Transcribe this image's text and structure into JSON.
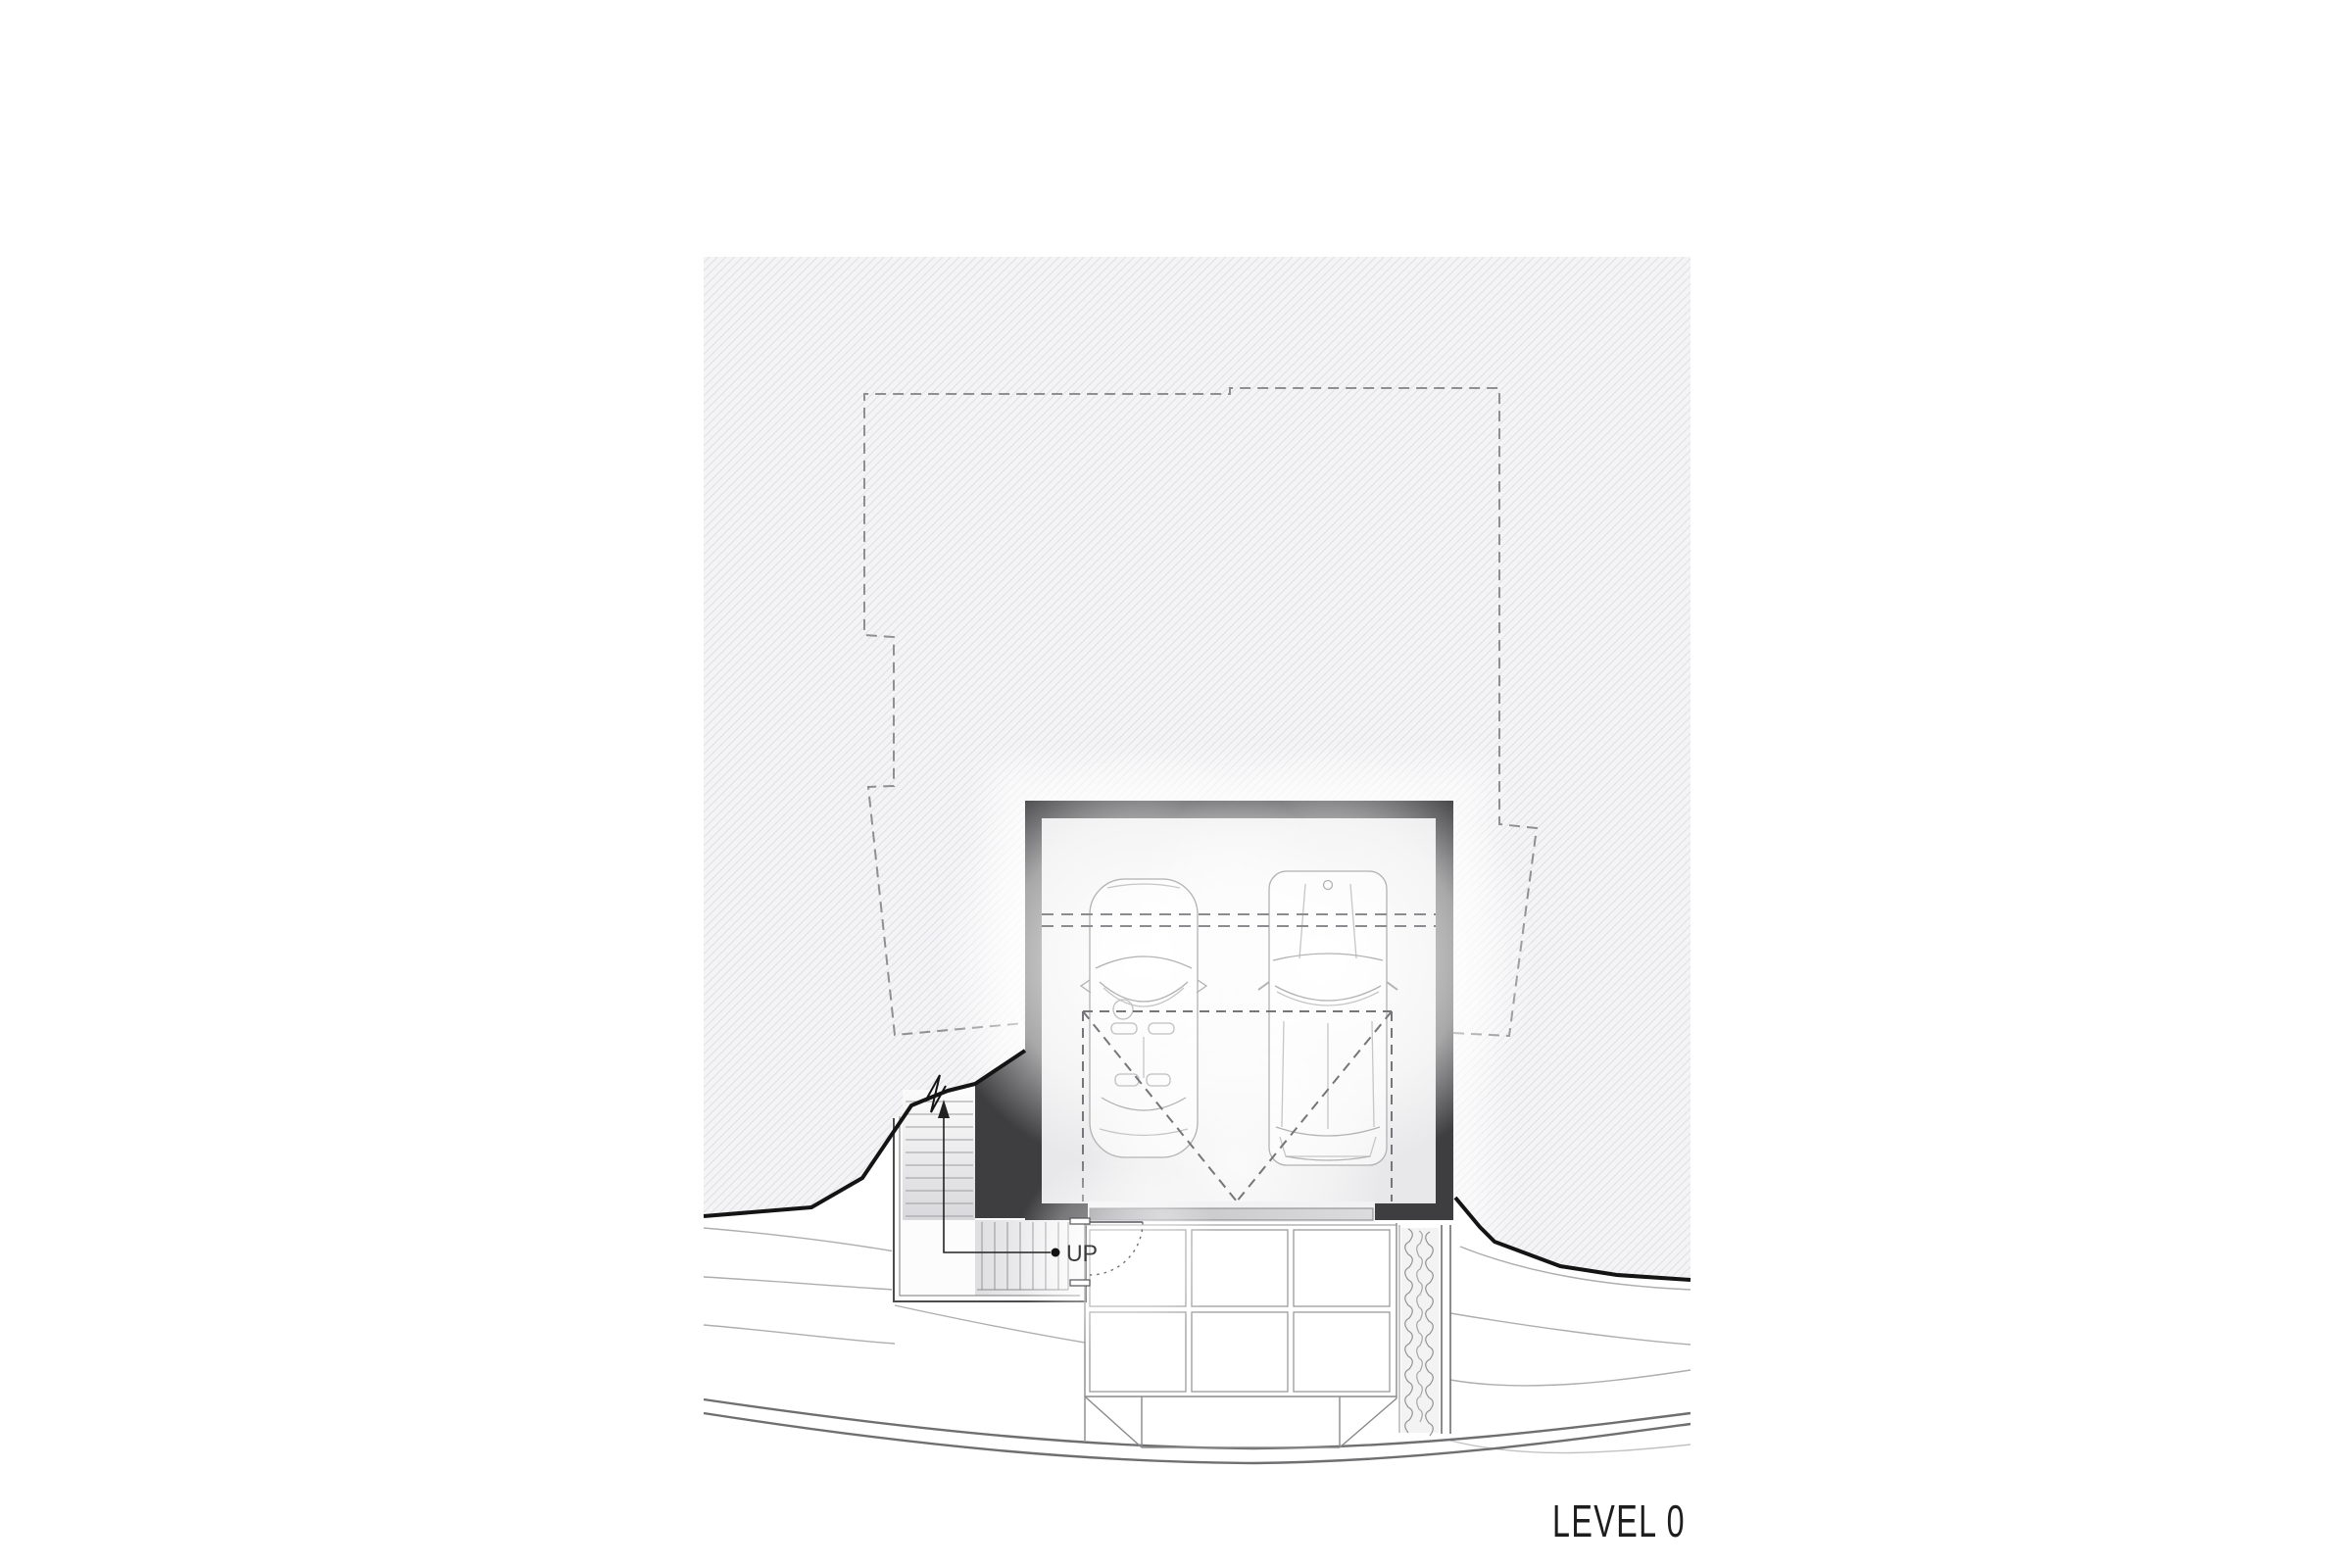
{
  "drawing": {
    "title": "LEVEL 0",
    "type": "architectural floor plan, garage level",
    "labels": {
      "stair_direction": "UP"
    },
    "elements": {
      "garage_cars": 2,
      "parking_stalls_dashed": 1,
      "stair_runs": 2,
      "driveway_paver_rows": 2,
      "driveway_paver_cols": 3,
      "hedge_strips": 1,
      "upper_floor_outline": "dashed",
      "site_contour_lines": 7
    },
    "palette": {
      "wall_poche": "#3e3e41",
      "garage_floor": "#e8e8ea",
      "site_hatch_bg": "#f4f4f6",
      "site_hatch_line": "#e1e1e5",
      "dashed_line": "#8f8f92",
      "contour_line": "#aeaeae",
      "road_line": "#6f6f72",
      "terrain_break_line": "#141414",
      "car_line": "#b2b2b4",
      "text_color": "#1d1d1d"
    }
  }
}
